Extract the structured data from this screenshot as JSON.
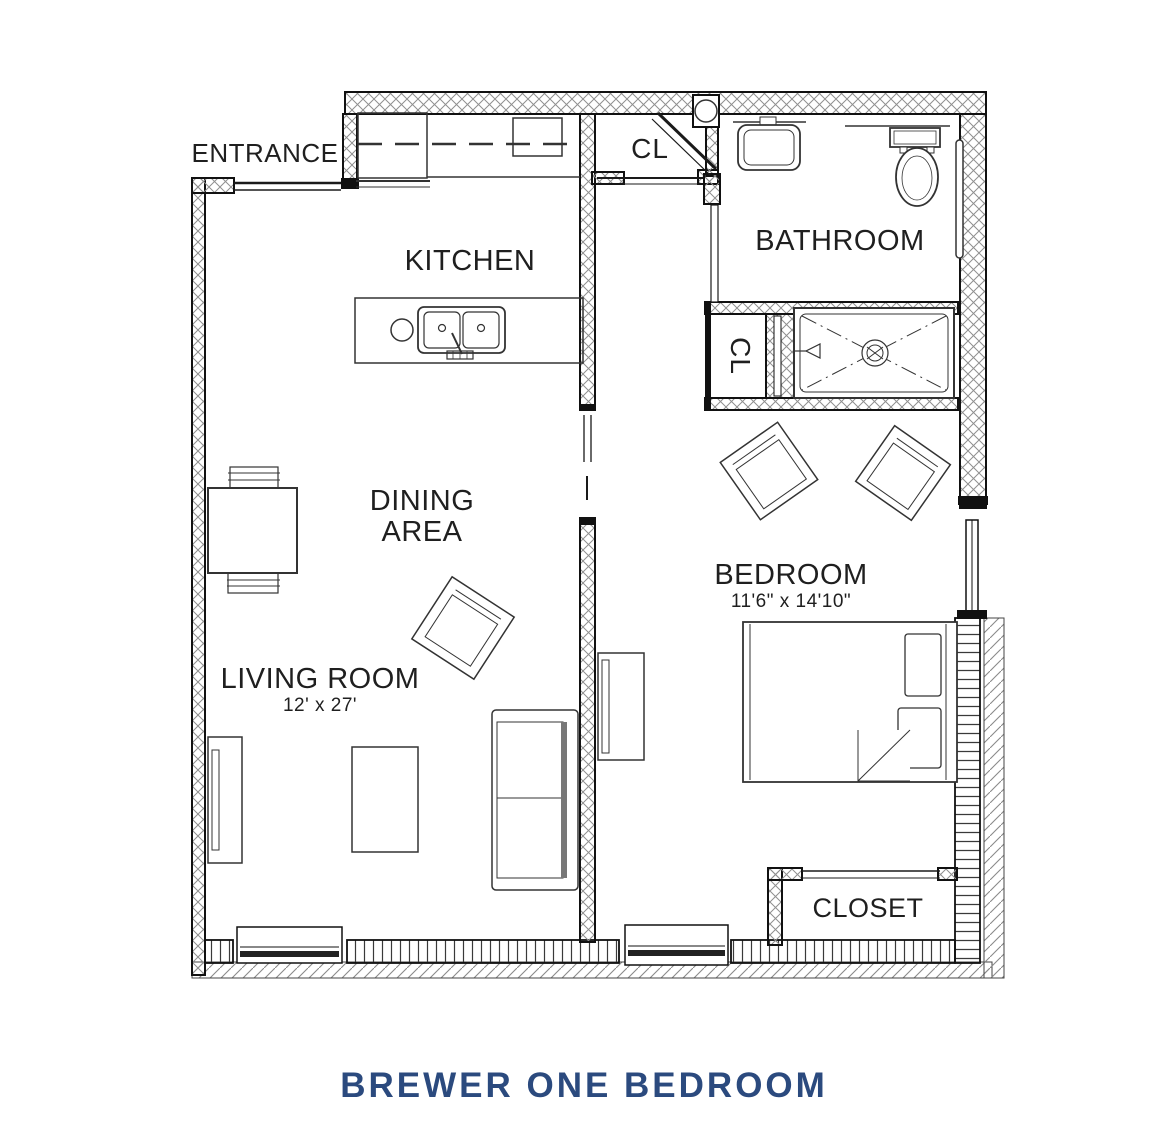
{
  "title": "BREWER ONE BEDROOM",
  "rooms": {
    "entrance": {
      "label": "ENTRANCE"
    },
    "kitchen": {
      "label": "KITCHEN"
    },
    "closet_top": {
      "label": "CL"
    },
    "bathroom": {
      "label": "BATHROOM"
    },
    "closet_hall": {
      "label": "CL"
    },
    "dining": {
      "label_line1": "DINING",
      "label_line2": "AREA"
    },
    "bedroom": {
      "label": "BEDROOM",
      "dimensions": "11'6\" x 14'10\""
    },
    "living": {
      "label": "LIVING ROOM",
      "dimensions": "12' x 27'"
    },
    "closet_bedroom": {
      "label": "CLOSET"
    }
  },
  "colors": {
    "title": "#2b4a7e",
    "line": "#1a1a1a"
  }
}
